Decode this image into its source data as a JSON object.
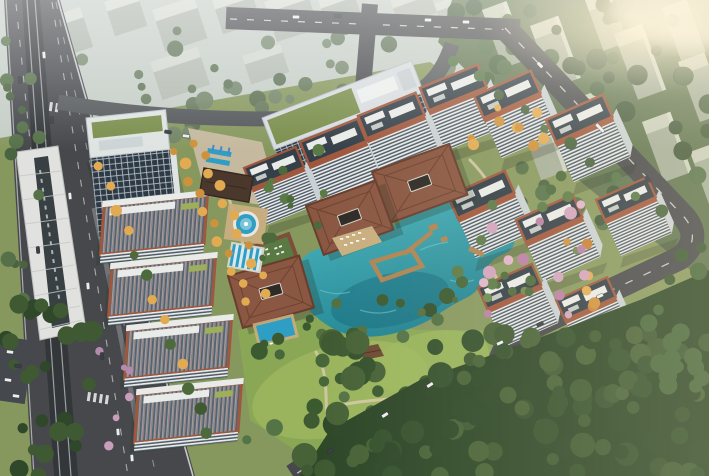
{
  "scene": {
    "type": "aerial-architectural-render",
    "subject": "residential-complex-with-central-lake-clubhouse-and-park",
    "structures": [
      "elevated-metro-viaduct",
      "metro-station-canopy",
      "office-tower",
      "office-slab-green-roof",
      "residential-towers",
      "roof-slabs",
      "clubhouse-pavilion-main",
      "clubhouse-pavilion-east",
      "clubhouse-pavilion-south",
      "entrance-gate-pavilion",
      "central-lake",
      "boardwalk-piers",
      "fountain-pool",
      "lap-pool",
      "south-pool",
      "golden-tree-promenade",
      "central-park-lawn",
      "park-cabin",
      "city-haze-background",
      "hillside-towers",
      "forest-belt",
      "roads"
    ]
  },
  "palette": {
    "base_lawn": "#87985f",
    "haze_band": "#c5cdc6",
    "bg_block_top": "#d7dbd3",
    "bg_block_side": "#adb5ab",
    "ne_ground": "#5e7350",
    "ne_block_side": "#a9b2a1",
    "ne_block_top": "#d2d6c6",
    "road": "#46484c",
    "road_minor": "#56595c",
    "road_line": "#eceded",
    "viaduct": "#34373a",
    "rail": "#9aa0a4",
    "station_roof": "#e1e2df",
    "station_dark": "#394043",
    "facade_white": "#e9eceb",
    "facade_side": "#c9d1d4",
    "facade_dark_row": "#4e5a66",
    "window_dark": "#2d3945",
    "window_line": "#c8d1d6",
    "roof_dark": "#343f48",
    "terracotta": "#9f573d",
    "green_roof": "#7b8f4d",
    "penthouse": "#e9ebe9",
    "pavilion_roof": "#8a5742",
    "pavilion_edge": "#693c2c",
    "entrance_roof": "#4a382c",
    "lake_light": "#4db7bf",
    "lake_deep": "#1f808f",
    "lake_shadow": "#156777",
    "pool": "#2f9ec4",
    "lane_light": "#d9e9ee",
    "deck": "#c9ae7f",
    "pier": "#b08453",
    "path": "#d4c8a6",
    "plaza": "#c8bca2",
    "lawn_light": "#9db85f",
    "park_lawn": "#8aa756",
    "forest_base": "#2d4728",
    "glow": "#fff3d6",
    "car_white": "#eceeee",
    "car_dark": "#3a3f45",
    "lot": "#45484c",
    "shadow": "#1e2a1a"
  },
  "tree_groups": [
    {
      "name": "bg-band-trees",
      "count": 40,
      "x": [
        0,
        460
      ],
      "y": [
        28,
        142
      ],
      "r": [
        4,
        9
      ],
      "colors": [
        "#66795c",
        "#73866a",
        "#5c7054"
      ],
      "seed": 11
    },
    {
      "name": "ne-trees",
      "count": 72,
      "x": [
        455,
        709
      ],
      "y": [
        0,
        245
      ],
      "r": [
        5,
        11
      ],
      "colors": [
        "#4c6544",
        "#43593c",
        "#57724b"
      ],
      "seed": 22
    },
    {
      "name": "e-edge-trees",
      "count": 22,
      "x": [
        645,
        709
      ],
      "y": [
        235,
        392
      ],
      "r": [
        5,
        10
      ],
      "colors": [
        "#3c5835",
        "#47663c"
      ],
      "seed": 33
    },
    {
      "name": "forest-trees",
      "count": 118,
      "x": [
        295,
        709
      ],
      "y": [
        330,
        476
      ],
      "r": [
        6,
        13
      ],
      "colors": [
        "#2e4829",
        "#35512e",
        "#3f5a33",
        "#486238"
      ],
      "seed": 44
    },
    {
      "name": "sw-trees",
      "count": 26,
      "x": [
        0,
        100
      ],
      "y": [
        300,
        476
      ],
      "r": [
        5,
        11
      ],
      "colors": [
        "#2e4829",
        "#3f5a33"
      ],
      "seed": 55
    },
    {
      "name": "wl-trees",
      "count": 16,
      "x": [
        0,
        40
      ],
      "y": [
        40,
        300
      ],
      "r": [
        4,
        8
      ],
      "colors": [
        "#4a6340",
        "#56714a"
      ],
      "seed": 66
    },
    {
      "name": "park-trees",
      "count": 24,
      "x": [
        245,
        500
      ],
      "y": [
        330,
        448
      ],
      "r": [
        4,
        9
      ],
      "colors": [
        "#47663a",
        "#3c5a30",
        "#547347"
      ],
      "seed": 77
    },
    {
      "name": "court-trees-a",
      "count": 12,
      "x": [
        255,
        330
      ],
      "y": [
        150,
        260
      ],
      "r": [
        3,
        6
      ],
      "colors": [
        "#4c6a3c",
        "#5b7a46"
      ],
      "seed": 88
    },
    {
      "name": "court-trees-b",
      "count": 18,
      "x": [
        455,
        580
      ],
      "y": [
        165,
        330
      ],
      "r": [
        3,
        6
      ],
      "colors": [
        "#4c6a3c",
        "#5b7a46",
        "#6b8a50"
      ],
      "seed": 99
    },
    {
      "name": "lakeside-trees",
      "count": 10,
      "x": [
        300,
        460
      ],
      "y": [
        300,
        345
      ],
      "r": [
        4,
        7
      ],
      "colors": [
        "#3c5a30",
        "#527042"
      ],
      "seed": 101
    },
    {
      "name": "blossoms-east",
      "count": 14,
      "x": [
        460,
        620
      ],
      "y": [
        190,
        320
      ],
      "r": [
        3.5,
        6.5
      ],
      "colors": [
        "#d2a3bf",
        "#b97fa4",
        "#e0b4cc"
      ],
      "seed": 112
    },
    {
      "name": "blossoms-west",
      "count": 6,
      "x": [
        90,
        140
      ],
      "y": [
        350,
        465
      ],
      "r": [
        3,
        5
      ],
      "colors": [
        "#b58bad",
        "#c79ebc"
      ],
      "seed": 123
    },
    {
      "name": "autumn-ne",
      "count": 9,
      "x": [
        470,
        545
      ],
      "y": [
        80,
        150
      ],
      "r": [
        3.5,
        6
      ],
      "colors": [
        "#cf923c",
        "#e2ab52"
      ],
      "seed": 134
    },
    {
      "name": "autumn-east-road",
      "count": 10,
      "x": [
        560,
        615
      ],
      "y": [
        235,
        355
      ],
      "r": [
        3.5,
        6
      ],
      "colors": [
        "#cf923c",
        "#e2ab52",
        "#c77f35"
      ],
      "seed": 145
    }
  ],
  "tree_rows": [
    {
      "name": "promenade-row-west",
      "from": [
        176,
        150
      ],
      "to": [
        248,
        300
      ],
      "count": 11,
      "r": 4.5,
      "alt": 4,
      "colors": [
        "#cf923c",
        "#e2ab52"
      ],
      "seed": 7
    },
    {
      "name": "promenade-row-east",
      "from": [
        196,
        142
      ],
      "to": [
        268,
        292
      ],
      "count": 11,
      "r": 4.5,
      "alt": 4,
      "colors": [
        "#e2ab52",
        "#cf923c"
      ],
      "seed": 8
    },
    {
      "name": "roadside-row",
      "from": [
        100,
        165
      ],
      "to": [
        208,
        432
      ],
      "count": 13,
      "r": 5,
      "alt": 3,
      "colors": [
        "#3f5a33",
        "#4c6a3c",
        "#e2ab52"
      ],
      "seed": 9
    },
    {
      "name": "ne-road-row",
      "from": [
        455,
        60
      ],
      "to": [
        660,
        212
      ],
      "count": 10,
      "r": 5,
      "alt": 3,
      "colors": [
        "#47623e",
        "#557547"
      ],
      "seed": 10
    }
  ],
  "cars": [
    {
      "x": 44,
      "y": 55,
      "rot": 84,
      "type": "white"
    },
    {
      "x": 52,
      "y": 120,
      "rot": 84,
      "type": "dark"
    },
    {
      "x": 70,
      "y": 196,
      "rot": 84,
      "type": "white"
    },
    {
      "x": 88,
      "y": 286,
      "rot": 85,
      "type": "white"
    },
    {
      "x": 102,
      "y": 356,
      "rot": 85,
      "type": "dark"
    },
    {
      "x": 118,
      "y": 432,
      "rot": 85,
      "type": "white"
    },
    {
      "x": 132,
      "y": 458,
      "rot": 85,
      "type": "white"
    },
    {
      "x": 20,
      "y": 80,
      "rot": 84,
      "type": "dark"
    },
    {
      "x": 38,
      "y": 250,
      "rot": 85,
      "type": "dark"
    },
    {
      "x": 296,
      "y": 17,
      "rot": 2,
      "type": "white"
    },
    {
      "x": 338,
      "y": 16,
      "rot": 2,
      "type": "dark"
    },
    {
      "x": 428,
      "y": 20,
      "rot": 2,
      "type": "white"
    },
    {
      "x": 466,
      "y": 22,
      "rot": 2,
      "type": "white"
    },
    {
      "x": 540,
      "y": 65,
      "rot": 46,
      "type": "white"
    },
    {
      "x": 600,
      "y": 128,
      "rot": 46,
      "type": "bus"
    },
    {
      "x": 648,
      "y": 179,
      "rot": 46,
      "type": "dark"
    },
    {
      "x": 600,
      "y": 296,
      "rot": -25,
      "type": "white"
    },
    {
      "x": 540,
      "y": 324,
      "rot": -25,
      "type": "dark"
    },
    {
      "x": 500,
      "y": 343,
      "rot": -25,
      "type": "white"
    },
    {
      "x": 430,
      "y": 385,
      "rot": -33,
      "type": "white"
    },
    {
      "x": 385,
      "y": 415,
      "rot": -33,
      "type": "white"
    },
    {
      "x": 330,
      "y": 451,
      "rot": -33,
      "type": "dark"
    },
    {
      "x": 168,
      "y": 132,
      "rot": 8,
      "type": "dark"
    },
    {
      "x": 186,
      "y": 136,
      "rot": 8,
      "type": "white"
    },
    {
      "x": 10,
      "y": 352,
      "rot": 8,
      "type": "white"
    },
    {
      "x": 18,
      "y": 366,
      "rot": 8,
      "type": "dark"
    },
    {
      "x": 8,
      "y": 380,
      "rot": 8,
      "type": "white"
    },
    {
      "x": 16,
      "y": 396,
      "rot": 8,
      "type": "white"
    }
  ]
}
